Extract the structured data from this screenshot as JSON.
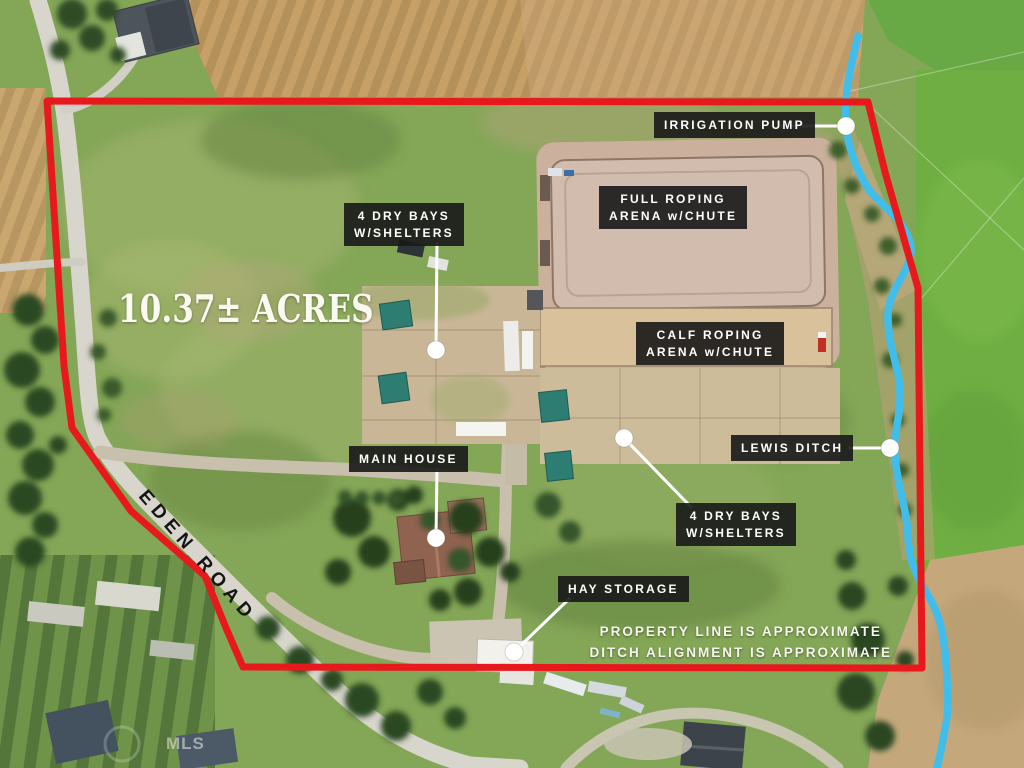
{
  "scene": {
    "acreage_text": "10.37± ACRES",
    "road_name": "EDEN ROAD",
    "watermark": "MLS"
  },
  "colors": {
    "boundary_red": "#e8191d",
    "ditch_blue": "#41bdec",
    "label_background": "#1a1a1a",
    "label_text": "#ffffff",
    "marker_white": "#ffffff"
  },
  "labels": [
    {
      "id": "irrigation-pump",
      "text": "IRRIGATION PUMP"
    },
    {
      "id": "full-roping-arena",
      "line1": "FULL ROPING",
      "line2": "ARENA w/CHUTE"
    },
    {
      "id": "dry-bays-north",
      "line1": "4 DRY BAYS",
      "line2": "W/SHELTERS"
    },
    {
      "id": "calf-roping-arena",
      "line1": "CALF ROPING",
      "line2": "ARENA w/CHUTE"
    },
    {
      "id": "lewis-ditch",
      "text": "LEWIS DITCH"
    },
    {
      "id": "main-house",
      "text": "MAIN HOUSE"
    },
    {
      "id": "dry-bays-south",
      "line1": "4 DRY BAYS",
      "line2": "W/SHELTERS"
    },
    {
      "id": "hay-storage",
      "text": "HAY STORAGE"
    }
  ],
  "disclaimer": {
    "line1": "PROPERTY LINE IS APPROXIMATE",
    "line2": "DITCH ALIGNMENT IS APPROXIMATE"
  }
}
